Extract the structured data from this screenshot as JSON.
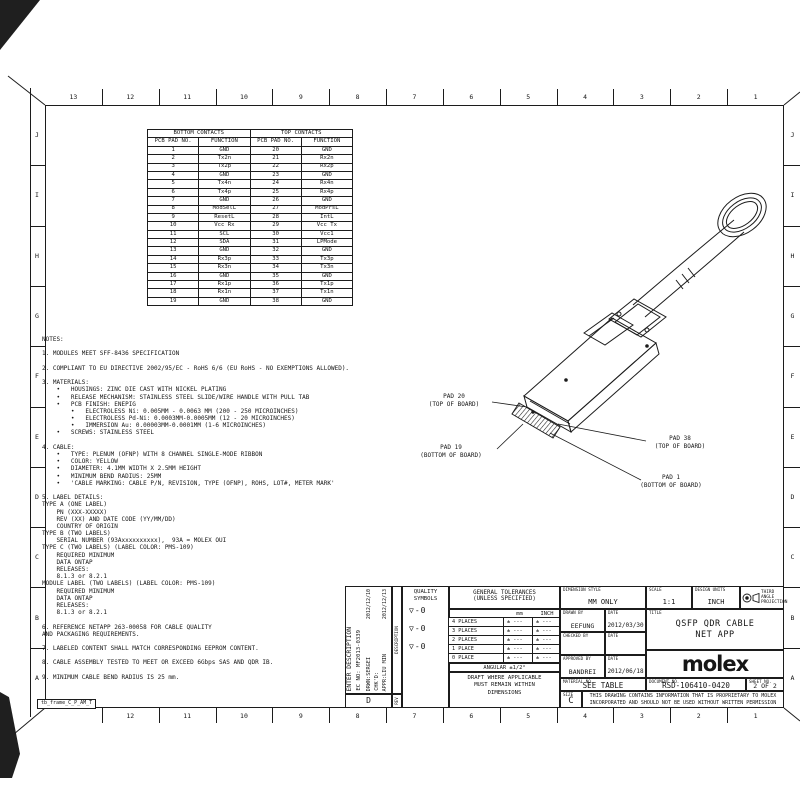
{
  "colors": {
    "ink": "#1c1c1c",
    "paper": "#ffffff"
  },
  "frame": {
    "label": "tb_frame_C_P_AM_T",
    "top_numbers": [
      "13",
      "12",
      "11",
      "10",
      "9",
      "8",
      "7",
      "6",
      "5",
      "4",
      "3",
      "2",
      "1"
    ],
    "bottom_numbers": [
      "12",
      "11",
      "10",
      "9",
      "8",
      "7",
      "6",
      "5",
      "4",
      "3",
      "2",
      "1"
    ],
    "side_letters": [
      "J",
      "I",
      "H",
      "G",
      "F",
      "E",
      "D",
      "C",
      "B",
      "A"
    ]
  },
  "contacts_table": {
    "group_headers": [
      "BOTTOM CONTACTS",
      "TOP CONTACTS"
    ],
    "col_headers": [
      "PCB PAD NO.",
      "FUNCTION",
      "PCB PAD NO.",
      "FUNCTION"
    ],
    "rows": [
      [
        "1",
        "GND",
        "20",
        "GND"
      ],
      [
        "2",
        "Tx2n",
        "21",
        "Rx2n"
      ],
      [
        "3",
        "Tx2p",
        "22",
        "Rx2p"
      ],
      [
        "4",
        "GND",
        "23",
        "GND"
      ],
      [
        "5",
        "Tx4n",
        "24",
        "Rx4n"
      ],
      [
        "6",
        "Tx4p",
        "25",
        "Rx4p"
      ],
      [
        "7",
        "GND",
        "26",
        "GND"
      ],
      [
        "8",
        "ModSelL",
        "27",
        "ModPrsL"
      ],
      [
        "9",
        "ResetL",
        "28",
        "IntL"
      ],
      [
        "10",
        "Vcc Rx",
        "29",
        "Vcc Tx"
      ],
      [
        "11",
        "SCL",
        "30",
        "Vcc1"
      ],
      [
        "12",
        "SDA",
        "31",
        "LPMode"
      ],
      [
        "13",
        "GND",
        "32",
        "GND"
      ],
      [
        "14",
        "Rx3p",
        "33",
        "Tx3p"
      ],
      [
        "15",
        "Rx3n",
        "34",
        "Tx3n"
      ],
      [
        "16",
        "GND",
        "35",
        "GND"
      ],
      [
        "17",
        "Rx1p",
        "36",
        "Tx1p"
      ],
      [
        "18",
        "Rx1n",
        "37",
        "Tx1n"
      ],
      [
        "19",
        "GND",
        "38",
        "GND"
      ]
    ]
  },
  "notes": {
    "lines": [
      "NOTES:",
      "",
      "1. MODULES MEET SFF-8436 SPECIFICATION",
      "",
      "2. COMPLIANT TO EU DIRECTIVE 2002/95/EC - RoHS 6/6 (EU RoHS - NO EXEMPTIONS ALLOWED).",
      "",
      "3. MATERIALS:",
      "    •   HOUSINGS: ZINC DIE CAST WITH NICKEL PLATING",
      "    •   RELEASE MECHANISM: STAINLESS STEEL SLIDE/WIRE HANDLE WITH PULL TAB",
      "    •   PCB FINISH: ENEPIG",
      "        •   ELECTROLESS Ni: 0.005MM - 0.0063 MM (200 - 250 MICROINCHES)",
      "        •   ELECTROLESS Pd-Ni: 0.0003MM-0.0005MM (12 - 20 MICROINCHES)",
      "        •   IMMERSION Au: 0.00003MM-0.0001MM (1-6 MICROINCHES)",
      "    •   SCREWS: STAINLESS STEEL",
      "",
      "4. CABLE:",
      "    •   TYPE: PLENUM (OFNP) WITH 8 CHANNEL SINGLE-MODE RIBBON",
      "    •   COLOR: YELLOW",
      "    •   DIAMETER: 4.1MM WIDTH X 2.5MM HEIGHT",
      "    •   MINIMUM BEND RADIUS: 25MM",
      "    •   'CABLE MARKING: CABLE P/N, REVISION, TYPE (OFNP), ROHS, LOT#, METER MARK'",
      "",
      "5. LABEL DETAILS:",
      "TYPE A (ONE LABEL)",
      "    PN (XXX-XXXXX)",
      "    REV (XX) AND DATE CODE (YY/MM/DD)",
      "    COUNTRY OF ORIGIN",
      "TYPE B (TWO LABELS)",
      "    SERIAL NUMBER (93Axxxxxxxxxx),  93A = MOLEX OUI",
      "TYPE C (TWO LABELS) (LABEL COLOR: PMS-109)",
      "    REQUIRED MINIMUM",
      "    DATA ONTAP",
      "    RELEASES:",
      "    8.1.3 or 8.2.1",
      "MODULE LABEL (TWO LABELS) (LABEL COLOR: PMS-109)",
      "    REQUIRED MINIMUM",
      "    DATA ONTAP",
      "    RELEASES:",
      "    8.1.3 or 8.2.1",
      "",
      "6. REFERENCE NETAPP 263-00058 FOR CABLE QUALITY",
      "AND PACKAGING REQUIREMENTS.",
      "",
      "7. LABELED CONTENT SHALL MATCH CORRESPONDING EEPROM CONTENT.",
      "",
      "8. CABLE ASSEMBLY TESTED TO MEET OR EXCEED 6Gbps SAS AND QDR IB.",
      "",
      "9. MINIMUM CABLE BEND RADIUS IS 25 mm."
    ]
  },
  "callouts": [
    {
      "line1": "PAD 20",
      "line2": "(TOP OF BOARD)"
    },
    {
      "line1": "PAD 19",
      "line2": "(BOTTOM OF BOARD)"
    },
    {
      "line1": "PAD 38",
      "line2": "(TOP OF BOARD)"
    },
    {
      "line1": "PAD 1",
      "line2": "(BOTTOM OF BOARD)"
    }
  ],
  "title_block": {
    "revision": {
      "header": "ENTER DESCRIPTION",
      "ec_no": "EC NO: MF2013-0339",
      "drwn": "DRWN:SERGEI",
      "chkd": "CHK'D:",
      "appr": "APPR:LIU MIN",
      "date1": "2012/12/10",
      "date2": "2012/12/13",
      "rev_letter": "D",
      "desc_label": "DESCRIPTION",
      "rev_label": "REV"
    },
    "quality": {
      "header": "QUALITY SYMBOLS",
      "symbols": [
        "▽-0",
        "▽-0",
        "▽-0"
      ]
    },
    "tolerances": {
      "header1": "GENERAL TOLERANCES",
      "header2": "(UNLESS SPECIFIED)",
      "col_mm": "mm",
      "col_inch": "INCH",
      "rows": [
        [
          "4 PLACES",
          "± ---",
          "± ---"
        ],
        [
          "3 PLACES",
          "± ---",
          "± ---"
        ],
        [
          "2 PLACES",
          "± ---",
          "± ---"
        ],
        [
          "1 PLACE",
          "± ---",
          "± ---"
        ],
        [
          "0 PLACE",
          "± ---",
          "± ---"
        ]
      ],
      "angular": "ANGULAR ±1/2°",
      "draft": "DRAFT WHERE APPLICABLE MUST REMAIN WITHIN DIMENSIONS"
    },
    "dimension_style_label": "DIMENSION STYLE",
    "dimension_style": "MM ONLY",
    "scale_label": "SCALE",
    "scale": "1:1",
    "design_units_label": "DESIGN UNITS",
    "design_units": "INCH",
    "projection_line1": "THIRD ANGLE",
    "projection_line2": "PROJECTION",
    "drawn_by_label": "DRAWN BY",
    "drawn_by": "EEFUNG",
    "date_label": "DATE",
    "drawn_date": "2012/03/30",
    "checked_by_label": "CHECKED BY",
    "checked_by": "",
    "checked_date": "",
    "approved_by_label": "APPROVED BY",
    "approved_by": "BANDREI",
    "approved_date": "2012/06/18",
    "material_label": "MATERIAL NO.",
    "material": "SEE TABLE",
    "document_label": "DOCUMENT NO.",
    "document_no": "RSD-106410-0420",
    "sheet_label": "SHEET NO.",
    "sheet": "2 OF 2",
    "size_label": "SIZE",
    "size": "C",
    "title_label": "TITLE",
    "title_line1": "QSFP QDR CABLE",
    "title_line2": "NET APP",
    "logo": "molex",
    "proprietary": "THIS DRAWING CONTAINS INFORMATION THAT IS PROPRIETARY TO MOLEX INCORPORATED AND SHOULD NOT BE USED WITHOUT WRITTEN PERMISSION"
  }
}
